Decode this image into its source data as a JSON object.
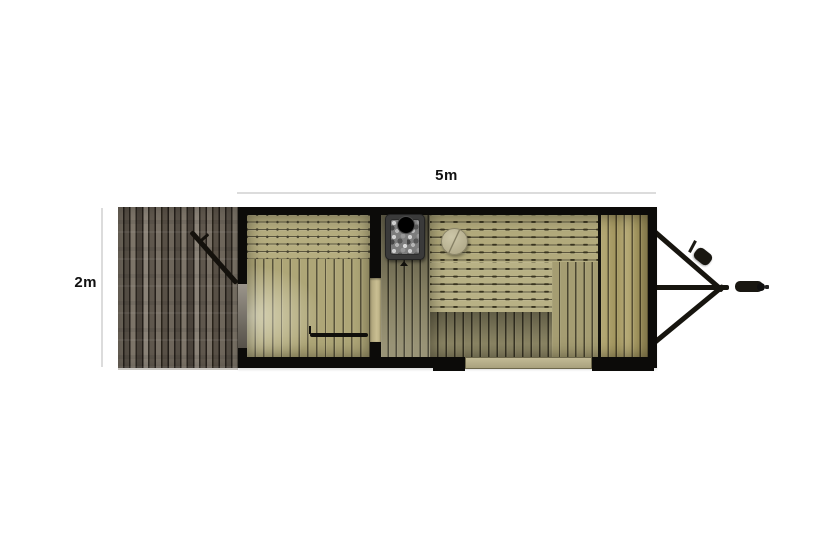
{
  "title": "Mobile sauna trailer floor plan (top view)",
  "dimensions": {
    "width_label": "5m",
    "depth_label": "2m"
  },
  "colors": {
    "background": "#ffffff",
    "wall": "#0c0b09",
    "dimension_line": "#dcdcdc",
    "text": "#111111",
    "bench_wood": "#b2aa7c",
    "floor_wood": "#aea677",
    "walkway_wood": "#8d8768",
    "deck_wood": "#655d52",
    "right_bench_wood": "#a3965f",
    "partition_door_wood": "#c9be92",
    "window_wood": "#c2ba95",
    "stove_body": "#3a3a3a",
    "stove_stones": "#7d7d7d",
    "stool_wood": "#c1ba9c",
    "hitch_metal": "#17150f"
  },
  "parts": {
    "deck": "wood-deck",
    "changing_room_bench": "bench-with-screws",
    "changing_room_floor": "plank-floor",
    "entry_door": "open-door-leaf",
    "partition_door": "partition-doorway",
    "stove": "sauna-stove-with-stones-and-chimney",
    "stool": "round-stool",
    "sauna_upper_bench": "upper-bench",
    "sauna_lower_bench": "lower-bench",
    "sauna_right_bench": "right-wall-bench",
    "window": "bottom-wall-window",
    "drawbar": "a-frame-drawbar",
    "coupler": "hitch-coupler",
    "jockey_wheel": "jockey-wheel"
  }
}
